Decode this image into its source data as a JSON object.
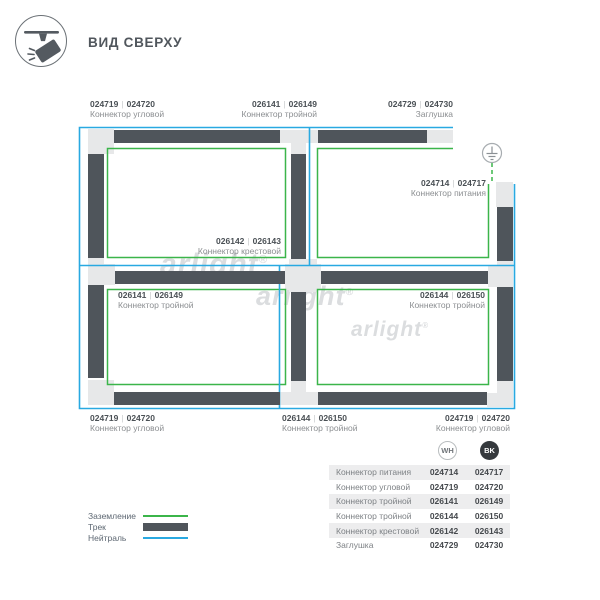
{
  "header": {
    "title": "ВИД СВЕРХУ"
  },
  "sep": "|",
  "watermark": {
    "text": "arlight",
    "reg": "®"
  },
  "diagram": {
    "labels": [
      {
        "code_wh": "024719",
        "code_bk": "024720",
        "name": "Коннектор угловой"
      },
      {
        "code_wh": "026141",
        "code_bk": "026149",
        "name": "Коннектор тройной"
      },
      {
        "code_wh": "024729",
        "code_bk": "024730",
        "name": "Заглушка"
      },
      {
        "code_wh": "024714",
        "code_bk": "024717",
        "name": "Коннектор питания"
      },
      {
        "code_wh": "026142",
        "code_bk": "026143",
        "name": "Коннектор крестовой"
      },
      {
        "code_wh": "026141",
        "code_bk": "026149",
        "name": "Коннектор тройной"
      },
      {
        "code_wh": "026144",
        "code_bk": "026150",
        "name": "Коннектор тройной"
      },
      {
        "code_wh": "024719",
        "code_bk": "024720",
        "name": "Коннектор угловой"
      },
      {
        "code_wh": "026144",
        "code_bk": "026150",
        "name": "Коннектор тройной"
      },
      {
        "code_wh": "024719",
        "code_bk": "024720",
        "name": "Коннектор угловой"
      }
    ]
  },
  "legend": {
    "items": [
      {
        "label": "Заземление"
      },
      {
        "label": "Трек"
      },
      {
        "label": "Нейтраль"
      }
    ]
  },
  "table": {
    "col_wh": "WH",
    "col_bk": "BK",
    "rows": [
      {
        "name": "Коннектор питания",
        "wh": "024714",
        "bk": "024717"
      },
      {
        "name": "Коннектор угловой",
        "wh": "024719",
        "bk": "024720"
      },
      {
        "name": "Коннектор тройной",
        "wh": "026141",
        "bk": "026149"
      },
      {
        "name": "Коннектор тройной",
        "wh": "026144",
        "bk": "026150"
      },
      {
        "name": "Коннектор крестовой",
        "wh": "026142",
        "bk": "026143"
      },
      {
        "name": "Заглушка",
        "wh": "024729",
        "bk": "024730"
      }
    ]
  },
  "colors": {
    "ground": "#3bb54a",
    "neutral": "#29a9e1",
    "track": "#4f555b",
    "connector": "#e7e8e9"
  }
}
